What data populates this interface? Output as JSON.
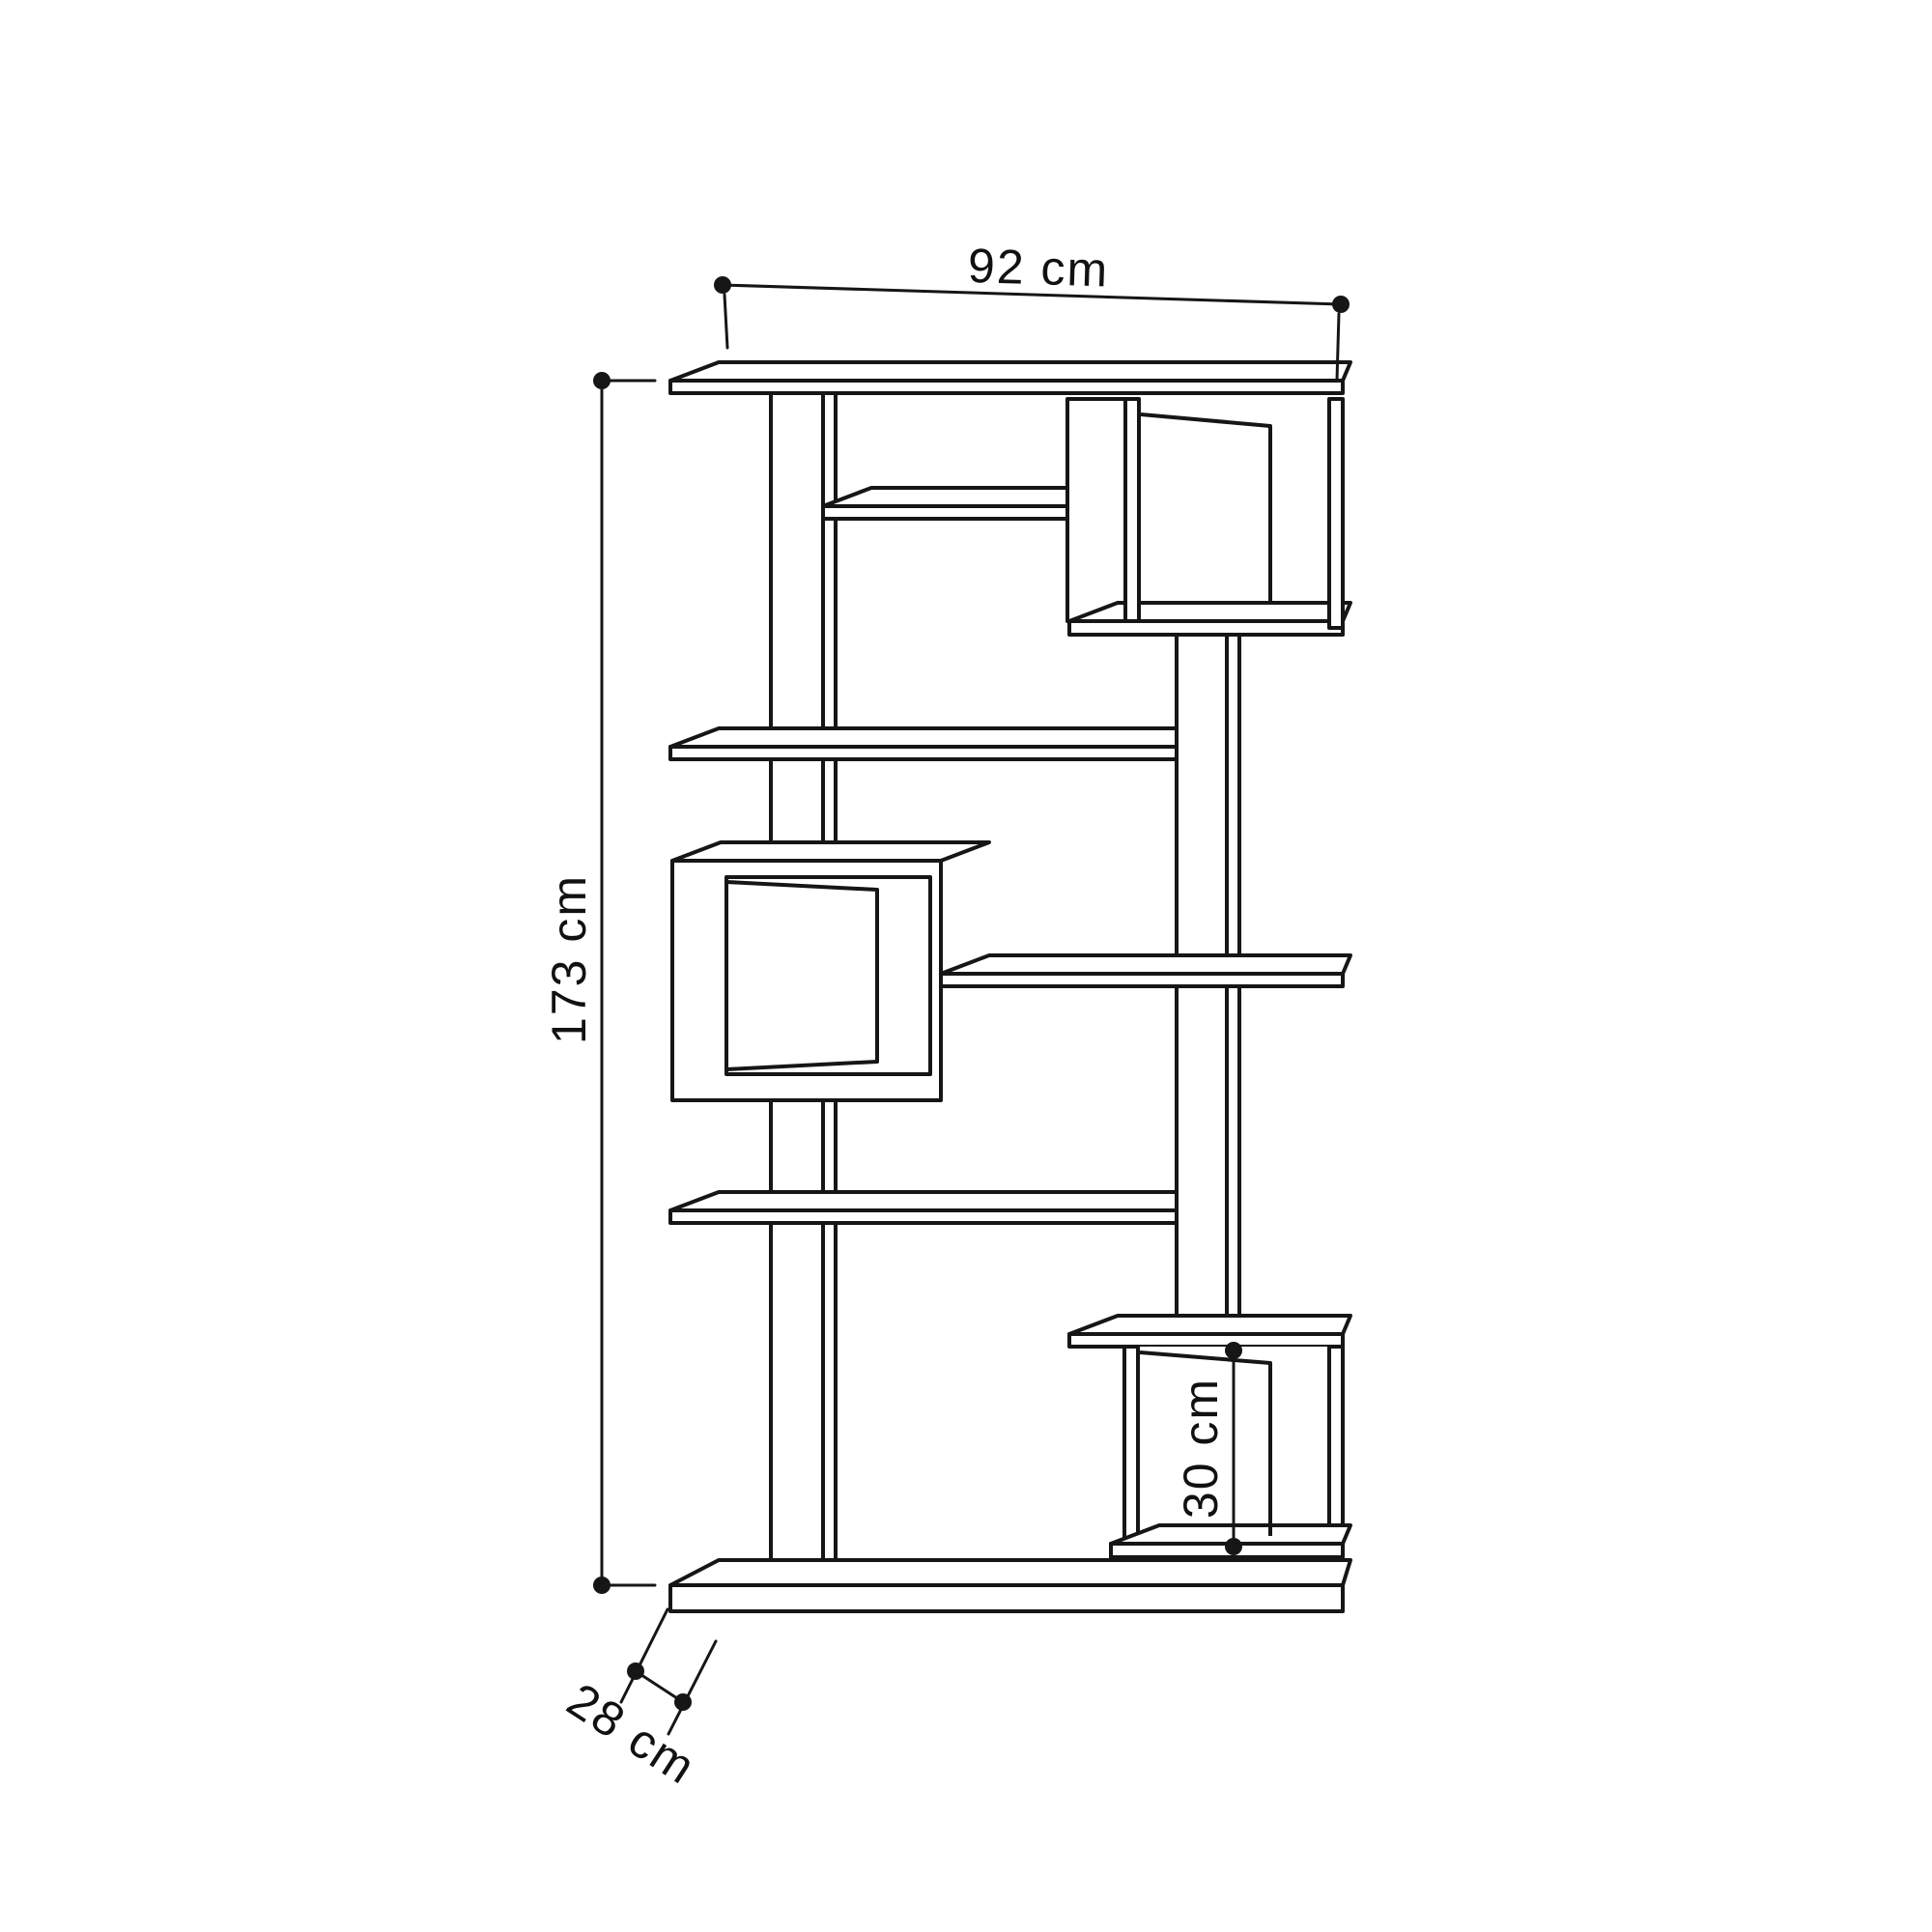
{
  "page": {
    "background": "#ffffff"
  },
  "diagram": {
    "kind": "furniture-dimension-line-drawing",
    "subject": "zig-zag open bookshelf with three cube niches, oblique projection",
    "line_color": "#161616",
    "labels": {
      "width": "92 cm",
      "height": "173 cm",
      "depth": "28 cm",
      "niche_height": "30 cm"
    }
  }
}
